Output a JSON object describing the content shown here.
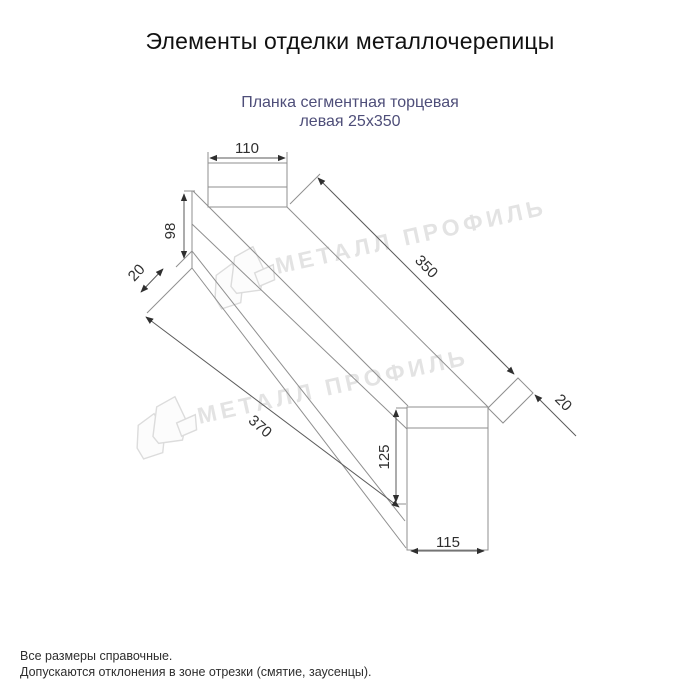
{
  "window": {
    "background_color": "#ffffff"
  },
  "header": {
    "title": "Элементы отделки металлочерепицы",
    "title_color": "#111111"
  },
  "product": {
    "name_line1": "Планка сегментная торцевая",
    "name_line2": "левая 25х350",
    "name_color": "#4e4e79"
  },
  "drawing": {
    "type": "technical-dimension-drawing",
    "units": "mm",
    "dimensions": {
      "end_cap_width": "110",
      "left_end_height": "98",
      "left_hem": "20",
      "top_edge_length": "350",
      "bottom_edge_length": "370",
      "right_flap": "20",
      "right_end_height": "125",
      "right_end_width": "115"
    },
    "line_color": "#8f8f8f",
    "dimension_text_color": "#2f2f2f"
  },
  "watermark": {
    "text": "МЕТАЛЛ ПРОФИЛЬ",
    "color": "#e3e3e3",
    "logo_icon": "metall-profil-house-logo"
  },
  "footer": {
    "note1": "Все размеры справочные.",
    "note2": "Допускаются отклонения в зоне отрезки (смятие, заусенцы)."
  }
}
